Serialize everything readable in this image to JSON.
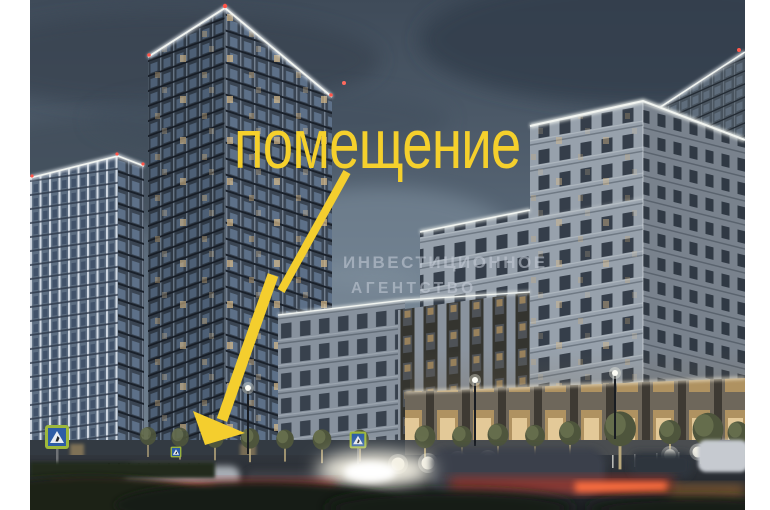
{
  "annotation": {
    "label": "помещение",
    "text_color": "#F5D02C",
    "arrow_color": "#F4CE2E",
    "arrow_direction": "points down-left to street-level premises"
  },
  "watermark": {
    "line1": "ИНВЕСТИЦИОННОЕ",
    "line2": "АГЕНТСТВО",
    "color": "rgba(198,205,216,0.55)"
  },
  "scene": {
    "subject": "evening render of residential towers and mid-rise building with street traffic",
    "colors": {
      "page_margin": "#ffffff",
      "sky_top": "#3f4b59",
      "sky_mid": "#5d7082",
      "dark_tower": "#323c48",
      "light_tower": "#5d6e82",
      "classic_building": "#97a1ac",
      "warm_window": "#dcbd8b",
      "tail_light_trail": "#c0392b",
      "cornice_light": "#f2f5f1"
    },
    "icons": {
      "pedestrian_crossing_sign": "green-bordered blue square with white triangle",
      "aviation_light": "small red dot on tower top",
      "street_lamp": "white glowing dot on pole",
      "bollard": "glowing white sphere"
    }
  }
}
